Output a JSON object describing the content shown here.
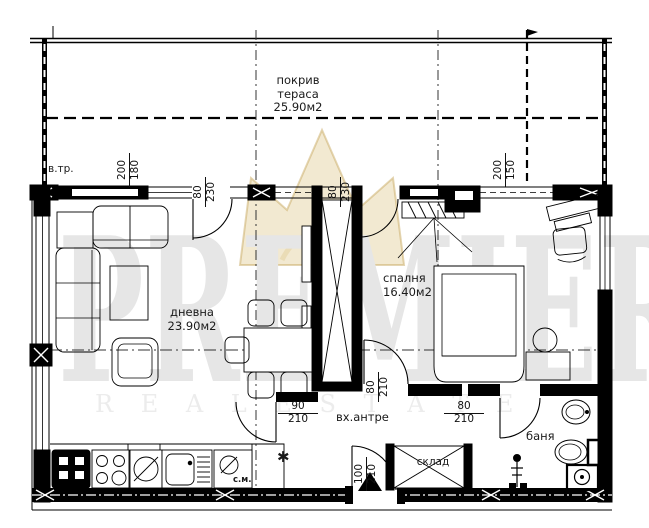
{
  "watermark": {
    "brand": "PREMIER",
    "tagline": "R E A L   E S T A T E",
    "crown_color": "#d6ba70"
  },
  "rooms": {
    "terrace": {
      "name_line1": "покрив",
      "name_line2": "тераса",
      "area": "25.90м2"
    },
    "living": {
      "name": "дневна",
      "area": "23.90м2"
    },
    "bedroom": {
      "name": "спалня",
      "area": "16.40м2"
    },
    "hall": {
      "name": "вх.антре"
    },
    "storage": {
      "name": "склад"
    },
    "bath": {
      "name": "баня"
    }
  },
  "labels": {
    "vent_shaft": "в.тр.",
    "washing_machine": "с.м.",
    "boiler_symbol": "✱"
  },
  "dimensions": {
    "top_left": {
      "num": "200",
      "den": "180"
    },
    "top_right": {
      "num": "200",
      "den": "150"
    },
    "living_terrace_door": {
      "num": "80",
      "den": "230"
    },
    "bedroom_terrace_door": {
      "num": "80",
      "den": "230"
    },
    "living_hall_door": {
      "num": "90",
      "den": "210"
    },
    "bath_door": {
      "num": "80",
      "den": "210"
    },
    "bedroom_door": {
      "num": "80",
      "den": "210"
    },
    "entrance_door": {
      "num": "100",
      "den": "210"
    }
  }
}
